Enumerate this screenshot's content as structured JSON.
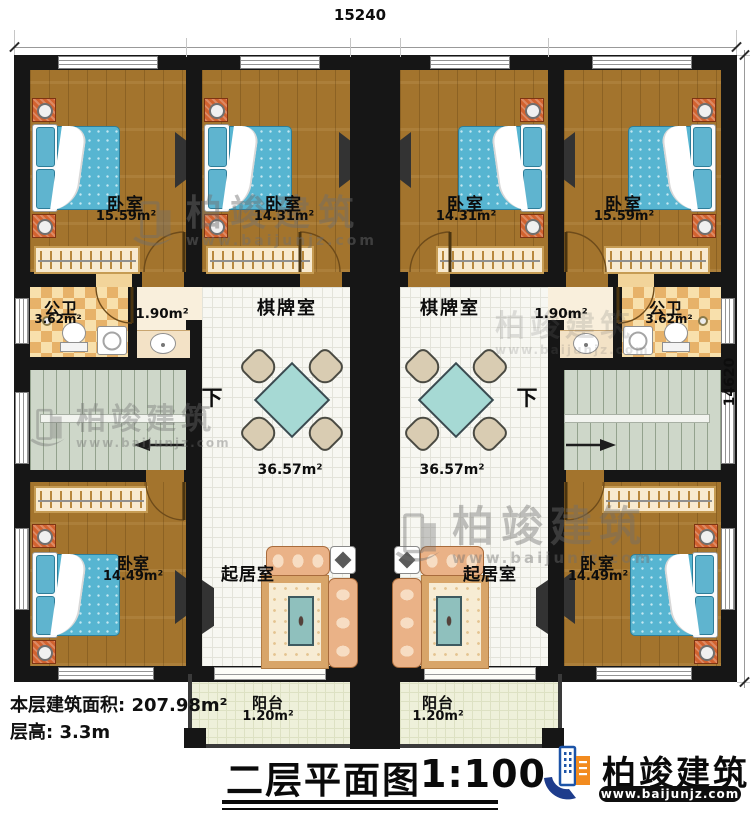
{
  "dimensions": {
    "top": "15240",
    "right": "14620"
  },
  "rooms": {
    "bedroom_tl": {
      "name": "卧室",
      "area": "15.59m²"
    },
    "bedroom_tml": {
      "name": "卧室",
      "area": "14.31m²"
    },
    "bedroom_tmr": {
      "name": "卧室",
      "area": "14.31m²"
    },
    "bedroom_tr": {
      "name": "卧室",
      "area": "15.59m²"
    },
    "bath_left": {
      "name": "公卫",
      "area": "3.62m²"
    },
    "bath_right": {
      "name": "公卫",
      "area": "3.62m²"
    },
    "wash_left": {
      "area": "1.90m²"
    },
    "wash_right": {
      "area": "1.90m²"
    },
    "games_left": {
      "name": "棋牌室",
      "area": "36.57m²"
    },
    "games_right": {
      "name": "棋牌室",
      "area": "36.57m²"
    },
    "stairs_left": {
      "down_label": "下"
    },
    "stairs_right": {
      "down_label": "下"
    },
    "living_left": {
      "name": "起居室"
    },
    "living_right": {
      "name": "起居室"
    },
    "bedroom_bl": {
      "name": "卧室",
      "area": "14.49m²"
    },
    "bedroom_br": {
      "name": "卧室",
      "area": "14.49m²"
    },
    "balcony_left": {
      "name": "阳台",
      "area": "1.20m²"
    },
    "balcony_right": {
      "name": "阳台",
      "area": "1.20m²"
    }
  },
  "info": {
    "line1": "本层建筑面积: 207.98m²",
    "line2": "层高: 3.3m"
  },
  "title": {
    "text": "二层平面图",
    "scale": "1:100"
  },
  "brand": {
    "name": "柏竣建筑",
    "url": "www.baijunjz.com"
  },
  "watermark": {
    "name": "柏竣建筑",
    "url": "www.baijunjz.com"
  },
  "colors": {
    "wall": "#161616",
    "wood_floor": "#a3742d",
    "bed": "#57b5d1",
    "brand_blue": "#1c54a8",
    "brand_orange": "#f28b1f"
  }
}
